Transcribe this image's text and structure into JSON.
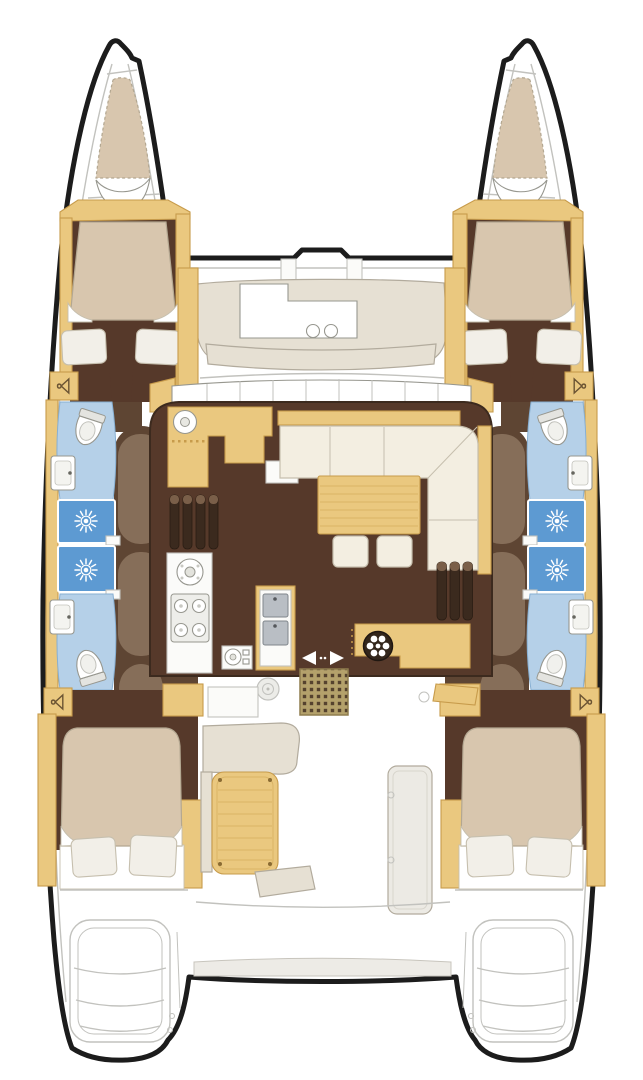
{
  "figure": {
    "type": "floor-plan",
    "subject": "catamaran interior and deck layout, top-down view",
    "visible_features": {
      "hulls": 2,
      "bow_berths": 2,
      "forward_double_cabins": 2,
      "aft_double_cabins": 2,
      "toilets": 4,
      "washbasins": 4,
      "shower_cells": 4,
      "wardrobes": 4,
      "saloon_sofa": 1,
      "saloon_table": 1,
      "ottomans": 2,
      "galley_burners": 4,
      "double_sink_bowls": 2,
      "cockpit_table": 1,
      "transom_step_flights": 2
    }
  },
  "icons": {
    "wardrobe": "hanger-icon",
    "shower_head": "spray-rose-icon",
    "toilet": "toilet-icon",
    "washbasin": "basin-icon",
    "galley_round_sink": "round-sink-icon",
    "stove": "four-burner-icon",
    "double_sink": "double-sink-icon",
    "sliding_door": "arrows-icon",
    "deck_fitting": "round-hatch-icon",
    "companionway_mat": "grid-mat-icon",
    "wet_bar_base": "round-wheel-icon"
  },
  "palette": {
    "outline": "#1c1c1c",
    "deck_white": "#ffffff",
    "line_gray": "#c2c2be",
    "wood": "#eac87f",
    "wood_dark": "#c79b4b",
    "wood_grain": "#d9b466",
    "cream": "#f3eee1",
    "cream_line": "#c6bfae",
    "mattress": "#d8c6ae",
    "mattress_line": "#b3a791",
    "pillow": "#f2efe8",
    "dark_brown": "#56392a",
    "floor_line": "#3c2a1e",
    "walkway": "#5e4533",
    "walkway_light": "#8d7660",
    "bath_blue": "#b5d0e8",
    "bath_blue_line": "#87afd2",
    "shower_blue": "#5d9ad2",
    "fixture_gray": "#e4e4e0",
    "fixture_line": "#97978f",
    "sink_gray": "#b9bec4",
    "sink_line": "#80868c",
    "mat_tan": "#b4a16b",
    "mat_dot": "#55422e",
    "mat_edge": "#8f7d4e",
    "seat_gray": "#e6e0d3",
    "seat_line": "#b2ab9d",
    "step_dark": "#3b2a1e",
    "step_cap": "#7a5f49",
    "white_box": "#fbfbf9",
    "wheel_dark": "#33261b"
  }
}
